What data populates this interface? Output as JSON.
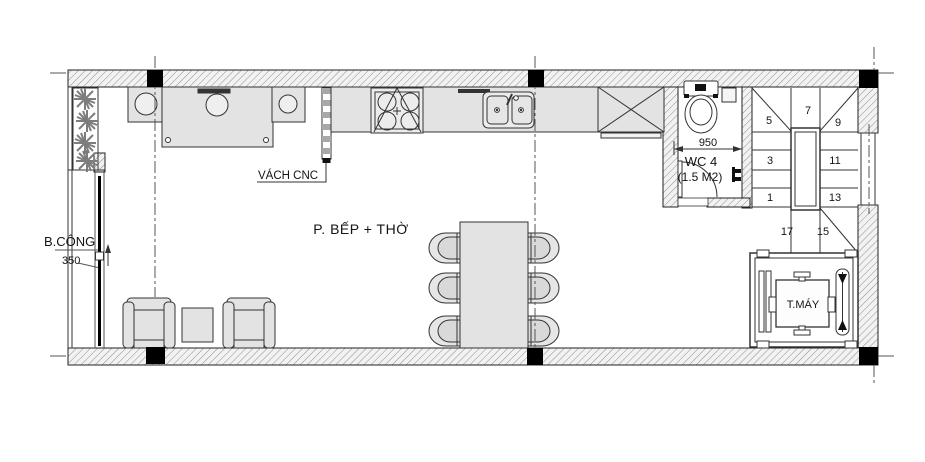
{
  "plan": {
    "room_label": "P. BẾP + THỜ",
    "balcony_label": "B.CÔNG",
    "balcony_dim": "350",
    "partition_label": "VÁCH CNC",
    "wc": {
      "name": "WC 4",
      "area": "(1.5 M2)",
      "width_dim": "950"
    },
    "elevator_label": "T.MÁY",
    "stair_steps": [
      "1",
      "3",
      "5",
      "7",
      "9",
      "11",
      "13",
      "15",
      "17"
    ]
  },
  "colors": {
    "line": "#222222",
    "furniture_fill": "#e3e3e3",
    "wall_base": "#f2f2f2",
    "hatch_line": "#8f8f8f",
    "column": "#000000"
  }
}
